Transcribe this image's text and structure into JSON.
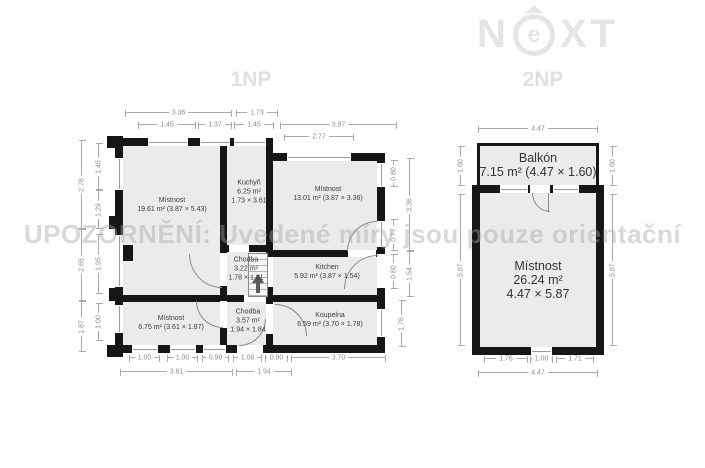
{
  "brand": {
    "n": "N",
    "e": "e",
    "xt": "XT"
  },
  "watermark": "UPOZORNĚNÍ: Uvedené míry jsou pouze orientační",
  "plan_1np": {
    "title": "1NP",
    "rooms": [
      {
        "cx": 172,
        "cy": 205,
        "lines": [
          "Místnost",
          "19.61 m² (3.87 × 5.43)"
        ]
      },
      {
        "cx": 249,
        "cy": 192,
        "lines": [
          "Kuchyň",
          "6.25 m²",
          "1.73 × 3.61"
        ]
      },
      {
        "cx": 328,
        "cy": 194,
        "lines": [
          "Místnost",
          "13.01 m² (3.87 × 3.36)"
        ]
      },
      {
        "cx": 246,
        "cy": 269,
        "lines": [
          "Chodba",
          "3.22 m²",
          "1.78 × 1.81"
        ]
      },
      {
        "cx": 327,
        "cy": 272,
        "lines": [
          "Kitchen",
          "5.92 m² (3.87 × 1.54)"
        ]
      },
      {
        "cx": 171,
        "cy": 323,
        "lines": [
          "Místnost",
          "6.75 m² (3.61 × 1.87)"
        ]
      },
      {
        "cx": 248,
        "cy": 321,
        "lines": [
          "Chodba",
          "3.57 m²",
          "1.94 × 1.84"
        ]
      },
      {
        "cx": 330,
        "cy": 320,
        "lines": [
          "Koupelna",
          "6.59 m² (3.70 × 1.78)"
        ]
      }
    ],
    "dims": [
      {
        "o": "h",
        "t": "3.36",
        "x": 125,
        "y": 112,
        "l": 107
      },
      {
        "o": "h",
        "t": "1.73",
        "x": 236,
        "y": 112,
        "l": 42
      },
      {
        "o": "h",
        "t": "1.45",
        "x": 138,
        "y": 124,
        "l": 58
      },
      {
        "o": "h",
        "t": "1.37",
        "x": 198,
        "y": 124,
        "l": 34
      },
      {
        "o": "h",
        "t": "1.45",
        "x": 234,
        "y": 124,
        "l": 40
      },
      {
        "o": "h",
        "t": "3.87",
        "x": 280,
        "y": 124,
        "l": 117
      },
      {
        "o": "h",
        "t": "2.77",
        "x": 284,
        "y": 136,
        "l": 70
      },
      {
        "o": "v",
        "t": "2.78",
        "x": 81,
        "y": 140,
        "l": 89
      },
      {
        "o": "v",
        "t": "2.65",
        "x": 81,
        "y": 229,
        "l": 72
      },
      {
        "o": "v",
        "t": "1.87",
        "x": 81,
        "y": 301,
        "l": 51
      },
      {
        "o": "v",
        "t": "1.45",
        "x": 98,
        "y": 143,
        "l": 47
      },
      {
        "o": "v",
        "t": "1.29",
        "x": 98,
        "y": 190,
        "l": 39
      },
      {
        "o": "v",
        "t": "1.95",
        "x": 98,
        "y": 234,
        "l": 60
      },
      {
        "o": "v",
        "t": "1.00",
        "x": 98,
        "y": 303,
        "l": 38
      },
      {
        "o": "v",
        "t": "0.80",
        "x": 393,
        "y": 160,
        "l": 27
      },
      {
        "o": "v",
        "t": "3.36",
        "x": 409,
        "y": 158,
        "l": 93
      },
      {
        "o": "v",
        "t": "0.77",
        "x": 393,
        "y": 219,
        "l": 32
      },
      {
        "o": "v",
        "t": "0.80",
        "x": 393,
        "y": 254,
        "l": 35
      },
      {
        "o": "v",
        "t": "1.54",
        "x": 409,
        "y": 251,
        "l": 46
      },
      {
        "o": "v",
        "t": "1.78",
        "x": 401,
        "y": 300,
        "l": 47
      },
      {
        "o": "h",
        "t": "1.00",
        "x": 129,
        "y": 357,
        "l": 31
      },
      {
        "o": "h",
        "t": "1.00",
        "x": 167,
        "y": 357,
        "l": 31
      },
      {
        "o": "h",
        "t": "0.98",
        "x": 202,
        "y": 357,
        "l": 27
      },
      {
        "o": "h",
        "t": "1.08",
        "x": 233,
        "y": 357,
        "l": 29
      },
      {
        "o": "h",
        "t": "0.80",
        "x": 265,
        "y": 357,
        "l": 23
      },
      {
        "o": "h",
        "t": "3.70",
        "x": 291,
        "y": 357,
        "l": 95
      },
      {
        "o": "h",
        "t": "3.61",
        "x": 120,
        "y": 371,
        "l": 113
      },
      {
        "o": "h",
        "t": "1.94",
        "x": 236,
        "y": 371,
        "l": 56
      }
    ]
  },
  "plan_2np": {
    "title": "2NP",
    "rooms": [
      {
        "cx": 538,
        "cy": 165,
        "big": true,
        "lines": [
          "Balkón",
          "7.15 m² (4.47 × 1.60)"
        ]
      },
      {
        "cx": 538,
        "cy": 280,
        "big": true,
        "lines": [
          "Místnost",
          "26.24 m²",
          "4.47 × 5.87"
        ]
      }
    ],
    "dims": [
      {
        "o": "h",
        "t": "4.47",
        "x": 478,
        "y": 128,
        "l": 120
      },
      {
        "o": "v",
        "t": "1.60",
        "x": 460,
        "y": 146,
        "l": 40
      },
      {
        "o": "v",
        "t": "1.60",
        "x": 612,
        "y": 146,
        "l": 40
      },
      {
        "o": "v",
        "t": "5.87",
        "x": 460,
        "y": 194,
        "l": 152
      },
      {
        "o": "v",
        "t": "5.87",
        "x": 612,
        "y": 194,
        "l": 152
      },
      {
        "o": "h",
        "t": "1.76",
        "x": 484,
        "y": 358,
        "l": 44
      },
      {
        "o": "h",
        "t": "1.00",
        "x": 530,
        "y": 358,
        "l": 23
      },
      {
        "o": "h",
        "t": "1.71",
        "x": 556,
        "y": 358,
        "l": 38
      },
      {
        "o": "h",
        "t": "4.47",
        "x": 478,
        "y": 372,
        "l": 120
      }
    ]
  }
}
